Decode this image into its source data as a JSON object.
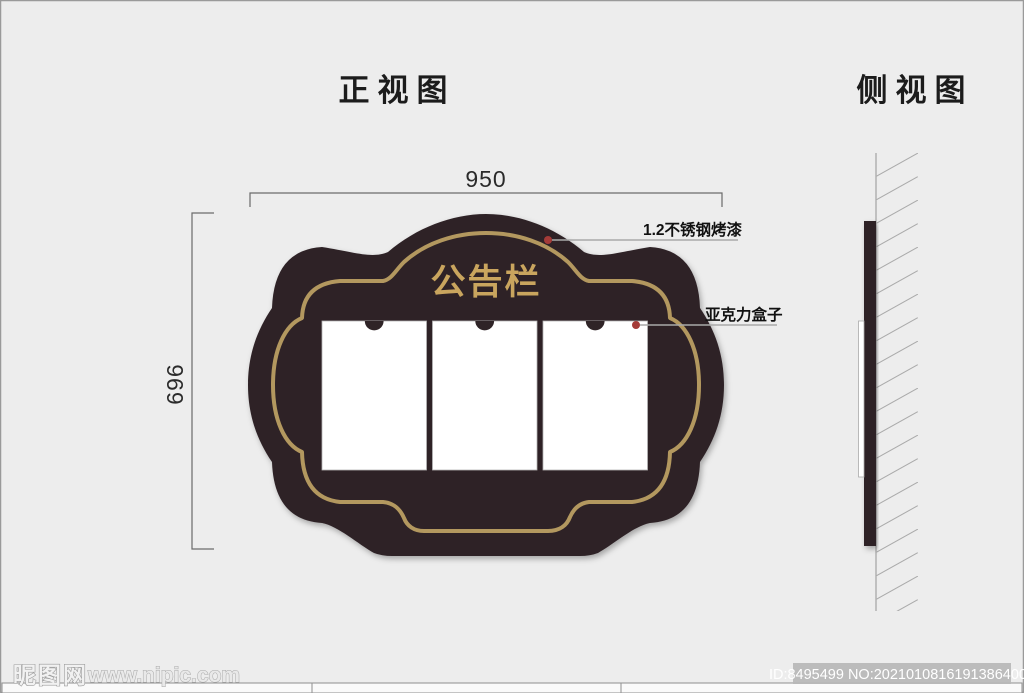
{
  "views": {
    "front": {
      "title": "正视图",
      "board_title": "公告栏",
      "width_dimension": "950",
      "height_dimension": "696",
      "annotations": [
        {
          "label": "1.2不锈钢烤漆"
        },
        {
          "label": "亚克力盒子"
        }
      ]
    },
    "side": {
      "title": "侧视图"
    }
  },
  "watermark": {
    "site_name": "昵图网",
    "site_url": "www.nipic.com",
    "image_id": "ID:8495499 NO:20210108161913864000"
  },
  "colors": {
    "board": "#2f2427",
    "gold_border": "#b3985f",
    "board_title_gold": "#c9a55e",
    "red_dot": "#a43b38"
  }
}
